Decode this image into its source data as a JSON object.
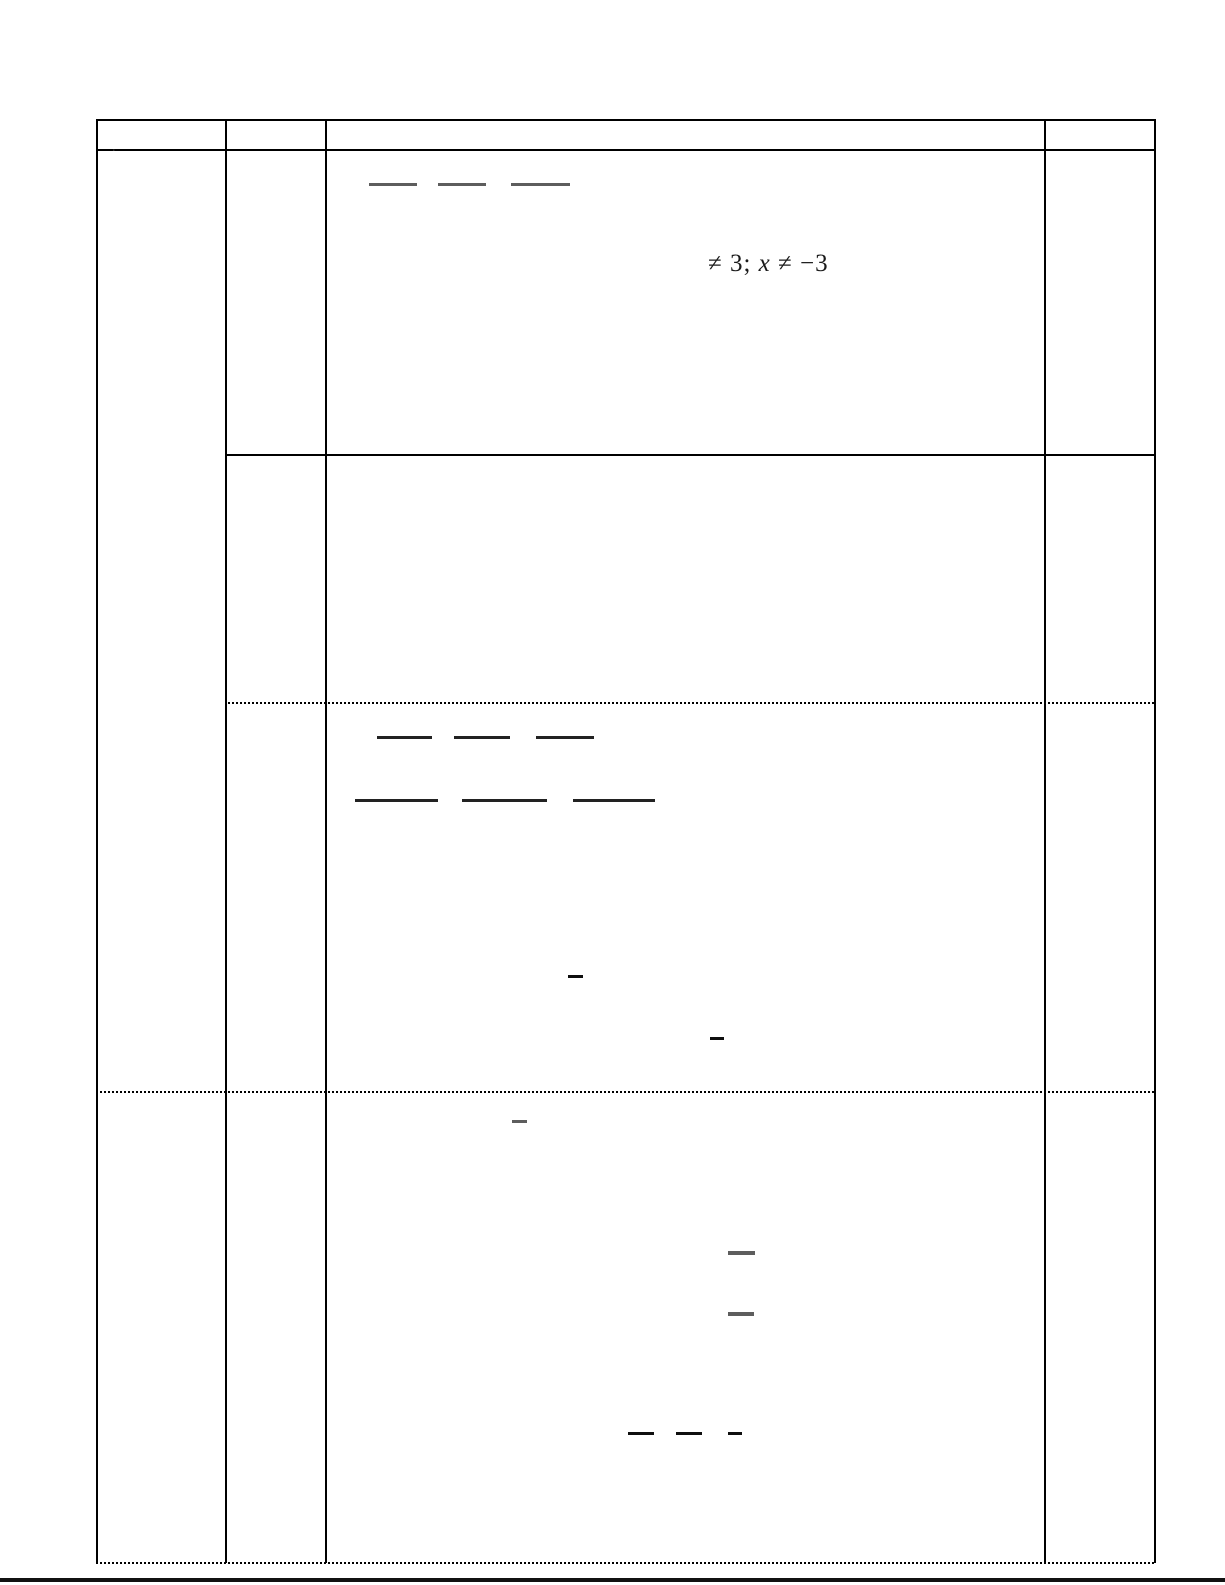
{
  "document": {
    "row_marker": ".",
    "math_line": {
      "prefix": "≠ 3; ",
      "variable": "x",
      "suffix": " ≠ −3"
    }
  },
  "colors": {
    "border": "#000000",
    "rule_thick": "#111111",
    "bar_dark": "#222222",
    "bar_black": "#0f0f0f",
    "bar_gray": "#5d5d5d"
  },
  "fragments": {
    "bars": [
      {
        "x": 369,
        "y": 183,
        "w": 48,
        "h": 3,
        "tone": "bar_gray"
      },
      {
        "x": 438,
        "y": 183,
        "w": 48,
        "h": 3,
        "tone": "bar_gray"
      },
      {
        "x": 511,
        "y": 183,
        "w": 59,
        "h": 3,
        "tone": "bar_gray"
      },
      {
        "x": 377,
        "y": 736,
        "w": 55,
        "h": 3,
        "tone": "bar_dark"
      },
      {
        "x": 454,
        "y": 736,
        "w": 56,
        "h": 3,
        "tone": "bar_dark"
      },
      {
        "x": 536,
        "y": 736,
        "w": 58,
        "h": 3,
        "tone": "bar_dark"
      },
      {
        "x": 355,
        "y": 799,
        "w": 83,
        "h": 3,
        "tone": "bar_dark"
      },
      {
        "x": 462,
        "y": 799,
        "w": 85,
        "h": 3,
        "tone": "bar_dark"
      },
      {
        "x": 573,
        "y": 799,
        "w": 82,
        "h": 3,
        "tone": "bar_dark"
      },
      {
        "x": 568,
        "y": 975,
        "w": 15,
        "h": 3,
        "tone": "bar_black"
      },
      {
        "x": 710,
        "y": 1037,
        "w": 14,
        "h": 3,
        "tone": "bar_black"
      },
      {
        "x": 512,
        "y": 1120,
        "w": 15,
        "h": 3,
        "tone": "bar_gray"
      },
      {
        "x": 728,
        "y": 1251,
        "w": 27,
        "h": 4,
        "tone": "bar_gray"
      },
      {
        "x": 728,
        "y": 1312,
        "w": 26,
        "h": 4,
        "tone": "bar_gray"
      },
      {
        "x": 628,
        "y": 1432,
        "w": 26,
        "h": 3,
        "tone": "bar_black"
      },
      {
        "x": 676,
        "y": 1432,
        "w": 26,
        "h": 3,
        "tone": "bar_black"
      },
      {
        "x": 728,
        "y": 1432,
        "w": 14,
        "h": 3,
        "tone": "bar_black"
      }
    ]
  }
}
